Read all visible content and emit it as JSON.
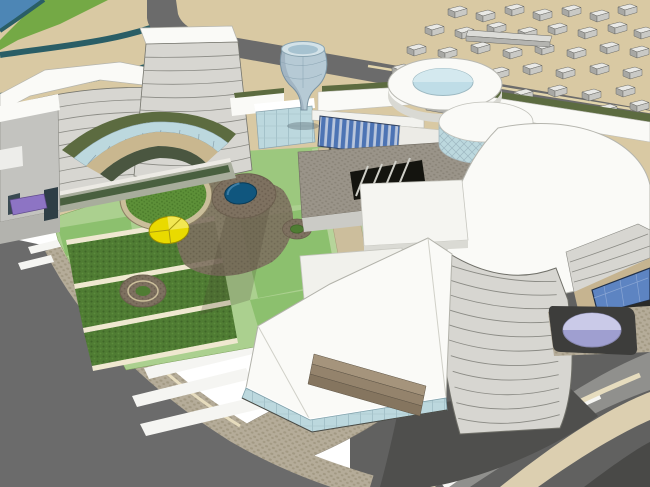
{
  "scene": {
    "kind": "aerial-3d-architectural-massing-render",
    "features": [
      "sand-terrain",
      "water-inlet",
      "river-channels",
      "city-block-field",
      "main-curved-building",
      "glass-cone-atrium",
      "ring-skylight-roof",
      "glass-drum-pavilion",
      "blue-curtain-wall-bridge",
      "courtyard-gardens",
      "circular-lawn",
      "yellow-pie-circle",
      "round-blue-pond",
      "planter-rings",
      "right-cylinder-tower",
      "white-wedge-tower",
      "zebra-crosswalk",
      "curved-ring-roads",
      "lavender-plaza-pond",
      "purple-entry-canopy"
    ]
  },
  "palette": {
    "sand": "#d9c9a3",
    "water_blue": "#4d86b5",
    "river_teal": "#2a5e66",
    "green_bank": "#74a945",
    "road_gray": "#6b6b6b",
    "road_mid": "#616160",
    "road_dark": "#4f4f4d",
    "road_darker": "#494947",
    "band_light_gray": "#90908d",
    "curb_beige": "#dccfb0",
    "curb_white": "#f5f5f2",
    "curb_cream": "#e6dcbe",
    "sidewalk": "#b5ac99",
    "sidewalk_dot": "#a29983",
    "wall_texture": "#9a9489",
    "wall_texture_dot": "#8a8478",
    "white_roof": "#fafaf7",
    "roof_edge": "#b5b5ae",
    "facade_light": "#d7d6d1",
    "facade_line": "#8b8b85",
    "glass_blue_pale": "#bcd8de",
    "glass_frame": "#8aa4ae",
    "curtain_blue": "#4d74b4",
    "curtain_mullion": "#b9c6dc",
    "glass_green": "#5c6b40",
    "terrace_tan": "#c9b78f",
    "inner_wall_green": "#4a5640",
    "floors_band": "#a8ad9c",
    "window_green": "#49603f",
    "lawn_light": "#abd08f",
    "lawn_mid": "#8cc06e",
    "lawn_pale": "#9cc87e",
    "lawn_dark": "#4f7c33",
    "lawn_dark_dot": "#3f6628",
    "circle_lawn": "#5d9038",
    "circle_lawn_dot": "#4a7a2a",
    "ring_tan": "#cabe9a",
    "path_cream": "#efe8d0",
    "path_tan": "#ccbe9c",
    "hedge_green": "#b6d49a",
    "earth_brown": "#7e7160",
    "earth_dot": "#6d6051",
    "pond_blue": "#10567e",
    "pond_edge": "#0a3a55",
    "circle_yellow": "#e9da00",
    "circle_yellow_hi": "#f2e752",
    "canopy_purple": "#8d74c4",
    "plaza_lavender": "#9f9fd0",
    "plaza_lavender_hi": "#cacae8",
    "pad_dark": "#3d3d3b",
    "window_dark": "#2e3e46",
    "tunnel_black": "#14140f",
    "block_top": "#e9e9e6",
    "block_side": "#a8a8a4",
    "block_front": "#c9c9c5",
    "block_edge": "#6a6a66",
    "cone_glass": "#b6cad5",
    "cone_rim": "#d3e2e8",
    "cone_rim_inner": "#a6c2d0",
    "skylight_blue": "#bfdde7",
    "skylight_hi": "#d4e9ef",
    "steps_tan1": "#a5947c",
    "steps_tan2": "#94836c",
    "steps_tan3": "#85755f",
    "tan_wall": "#c6b490",
    "annex_gray": "#c3c3bf",
    "apron_gray": "#cbcbc6"
  }
}
